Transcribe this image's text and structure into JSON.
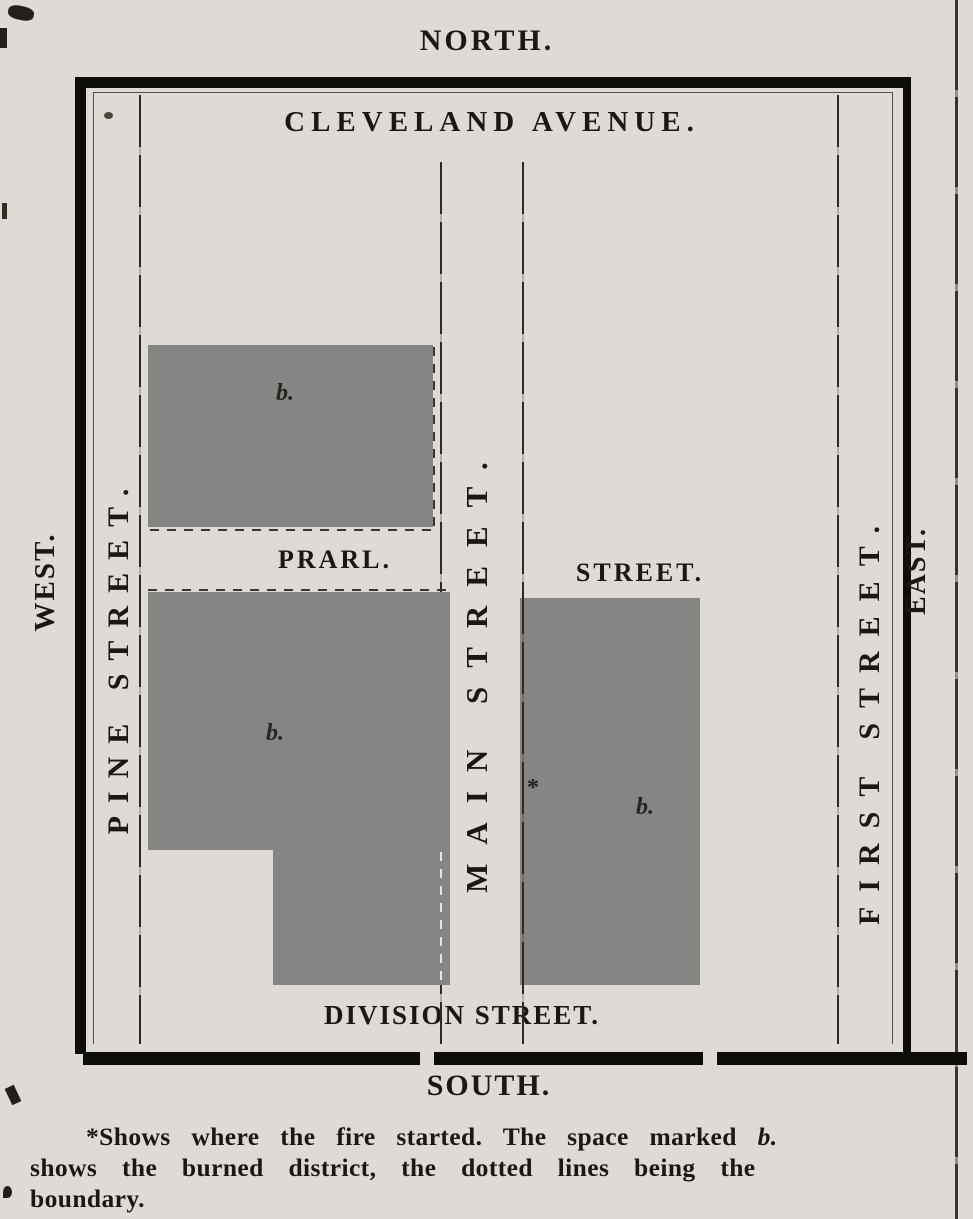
{
  "colors": {
    "paper": "#dedbd6",
    "ink": "#1b1713",
    "heavy_border": "#0f0d0a",
    "burned_area_gray": "#868584"
  },
  "compass": {
    "north": "NORTH.",
    "south": "SOUTH.",
    "east": "EAST.",
    "west": "WEST."
  },
  "streets": {
    "top": "CLEVELAND AVENUE.",
    "left_vertical": "PINE STREET.",
    "center_vertical": "MAIN STREET.",
    "right_vertical": "FIRST STREET.",
    "pearl_west_segment": "PRARL.",
    "pearl_east_segment": "STREET.",
    "bottom": "DIVISION STREET."
  },
  "markers": {
    "burned_block_label": "b.",
    "fire_origin": "*"
  },
  "caption": {
    "line1_text": "*Shows where the fire started.  The space marked",
    "line1_marker": "b.",
    "line2": "shows the burned district, the dotted lines being the",
    "line3": "boundary."
  }
}
